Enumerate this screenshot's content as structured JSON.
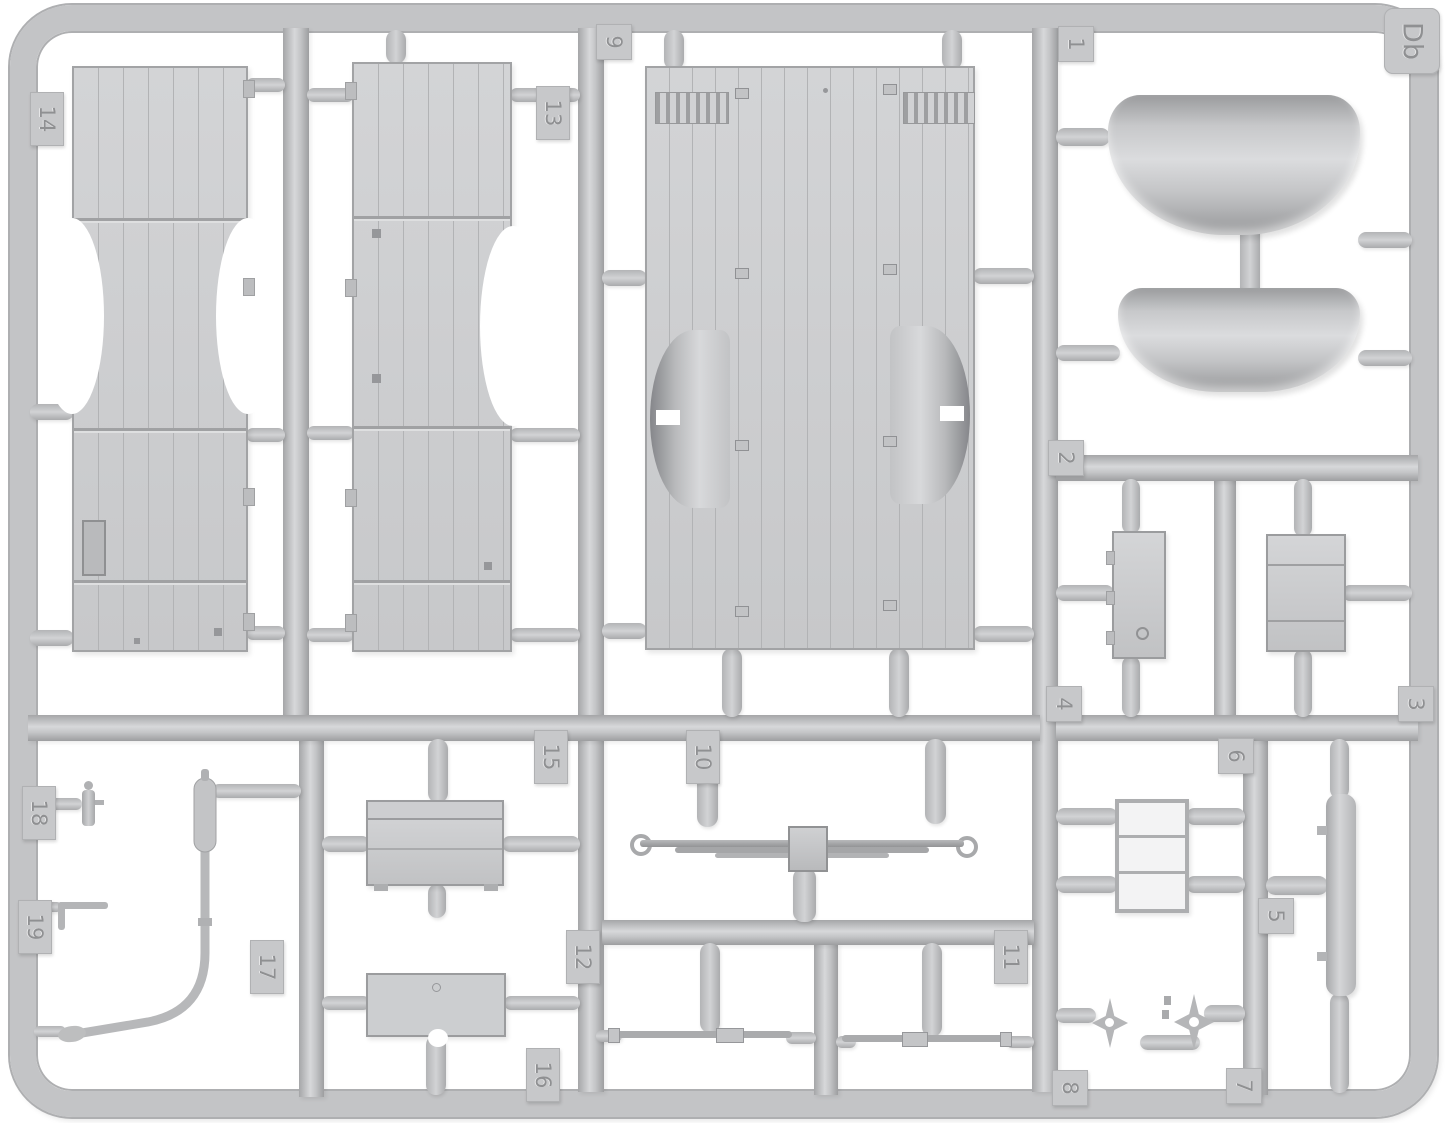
{
  "sprue": {
    "letter": "Db",
    "plastic_color": "#c6c7c9",
    "background_color": "#ffffff"
  },
  "tags": {
    "t1": "1",
    "t2": "2",
    "t3": "3",
    "t4": "4",
    "t5": "5",
    "t6": "6",
    "t7": "7",
    "t8": "8",
    "t9": "9",
    "t10": "10",
    "t11": "11",
    "t12": "12",
    "t13": "13",
    "t14": "14",
    "t15": "15",
    "t16": "16",
    "t17": "17",
    "t18": "18",
    "t19": "19"
  }
}
